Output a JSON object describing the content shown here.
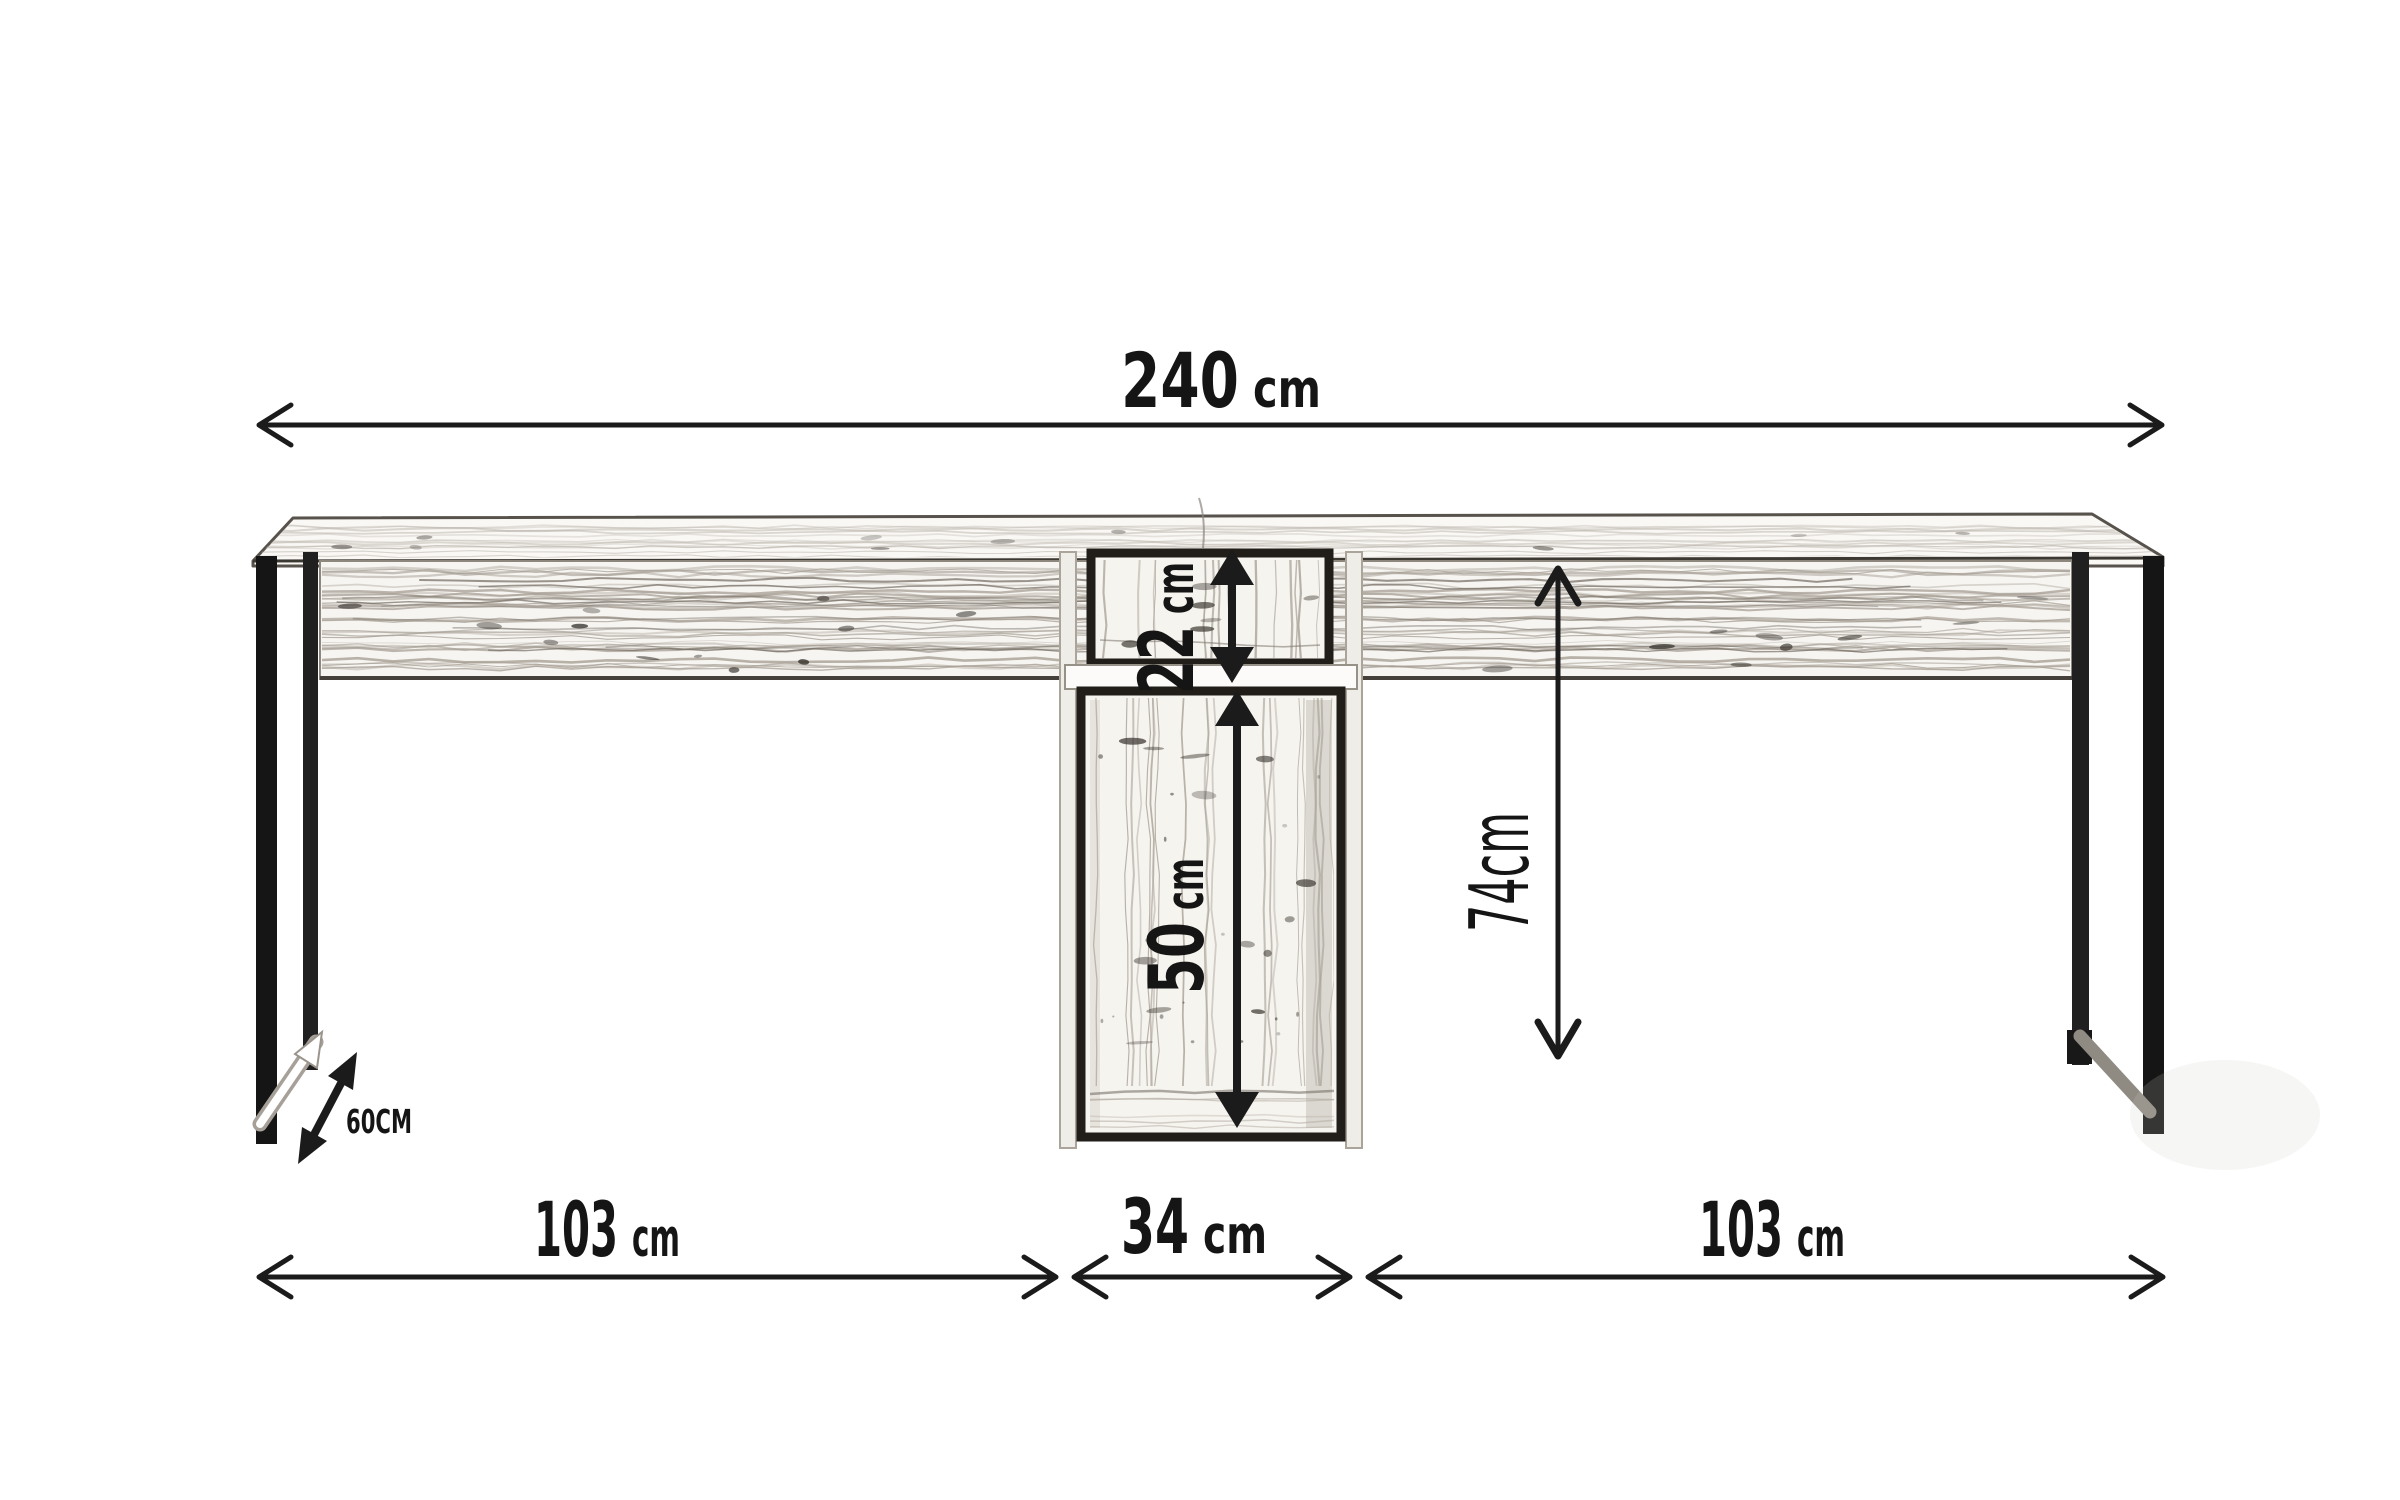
{
  "diagram": {
    "dims": {
      "total": {
        "value": "240",
        "unit": "cm"
      },
      "upper": {
        "value": "22",
        "unit": "cm"
      },
      "lower": {
        "value": "50",
        "unit": "cm"
      },
      "height": {
        "text": "74cm"
      },
      "depth": {
        "text": "60CM"
      },
      "left": {
        "value": "103",
        "unit": "cm"
      },
      "center": {
        "value": "34",
        "unit": "cm"
      },
      "right": {
        "value": "103",
        "unit": "cm"
      }
    },
    "colors": {
      "line": "#1b1b1b",
      "leg": "#151515",
      "grain": "#a59e94",
      "frame": "#211d18"
    }
  }
}
